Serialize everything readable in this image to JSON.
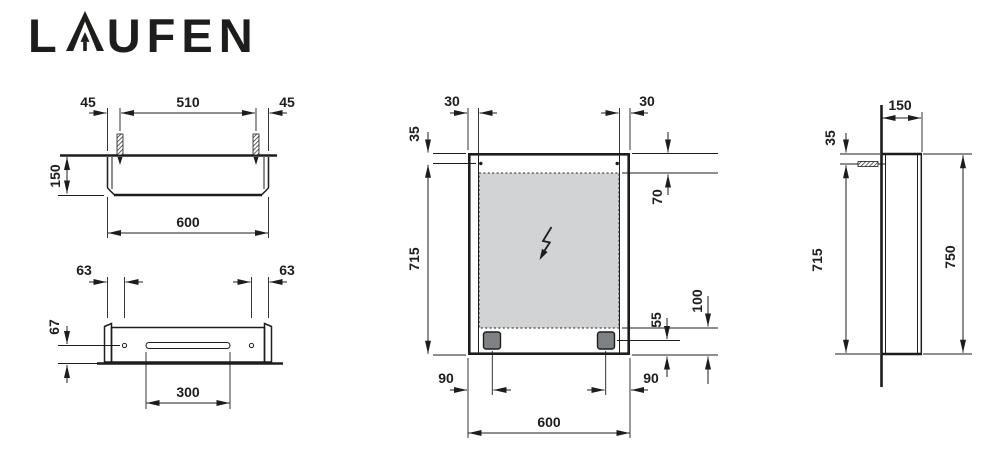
{
  "brand": {
    "logo_prefix": "L",
    "logo_suffix": "UFEN",
    "name": "LAUFEN"
  },
  "drawing": {
    "top_view": {
      "offset_left": "45",
      "hole_spacing": "510",
      "offset_right": "45",
      "depth": "150",
      "width": "600"
    },
    "bottom_view": {
      "hole_offset_left": "63",
      "hole_offset_right": "63",
      "hole_to_wall": "67",
      "slot_width": "300"
    },
    "front_view": {
      "hole_inset_left": "30",
      "hole_inset_right": "30",
      "hole_top": "35",
      "glass_top": "70",
      "mounting_height": "715",
      "spot_bottom": "55",
      "glass_bottom": "100",
      "spot_inset_left": "90",
      "spot_inset_right": "90",
      "width": "600"
    },
    "side_view": {
      "depth": "150",
      "hole_top": "35",
      "mounting_height": "715",
      "height": "750"
    }
  },
  "symbols": {
    "electrical_connection": "lightning-bolt"
  },
  "colors": {
    "line": "#1d1d1b",
    "glass_fill": "#d2d3d5",
    "spot_fill": "#7f8285"
  }
}
